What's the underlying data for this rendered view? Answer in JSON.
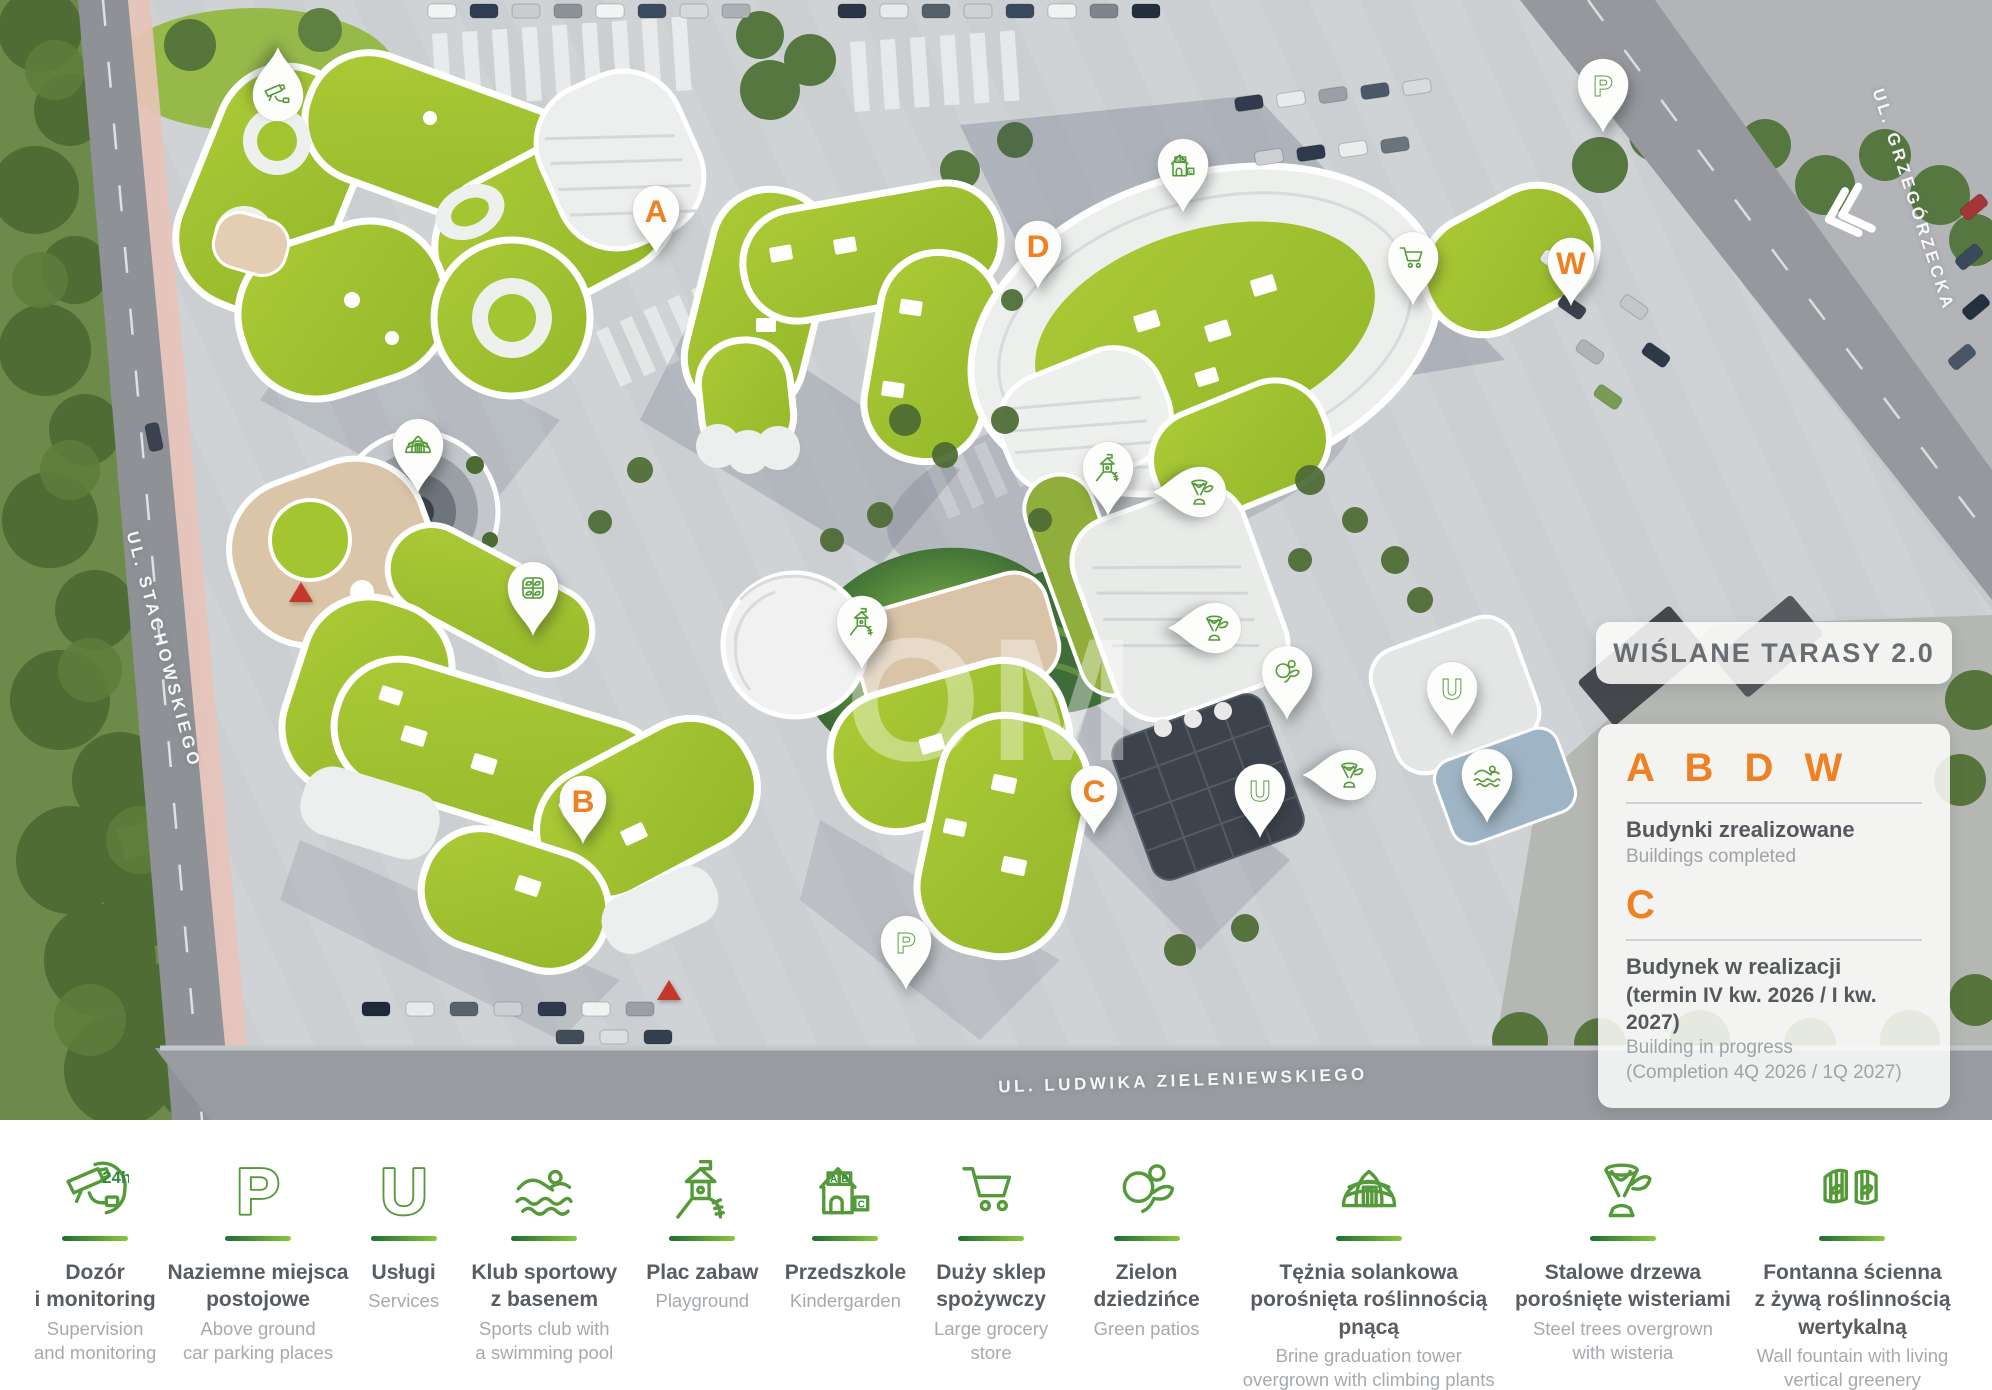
{
  "map": {
    "watermark": "OM",
    "title_panel": {
      "title": "WIŚLANE TARASY 2.0"
    },
    "status_panel": {
      "completed_letters": "A B D W",
      "completed_title_pl": "Budynki zrealizowane",
      "completed_title_en": "Buildings completed",
      "in_progress_letter": "C",
      "in_progress_title_pl": "Budynek w realizacji",
      "in_progress_term_pl": "(termin IV kw. 2026 / I kw. 2027)",
      "in_progress_title_en": "Building in progress",
      "in_progress_term_en": "(Completion 4Q 2026 / 1Q 2027)"
    },
    "streets": [
      {
        "name": "UL. STACHOWSKIEGO",
        "x": 163,
        "y": 650,
        "rotate": 75
      },
      {
        "name": "UL. GRZEGÓRZECKA",
        "x": 1913,
        "y": 200,
        "rotate": 72
      },
      {
        "name": "UL. LUDWIKA ZIELENIEWSKIEGO",
        "x": 1183,
        "y": 1081,
        "rotate": -2
      }
    ],
    "building_markers": [
      {
        "label": "A",
        "status": "completed",
        "x": 656,
        "y": 210
      },
      {
        "label": "D",
        "status": "completed",
        "x": 1038,
        "y": 245
      },
      {
        "label": "W",
        "status": "completed",
        "x": 1571,
        "y": 262
      },
      {
        "label": "B",
        "status": "completed",
        "x": 583,
        "y": 800
      },
      {
        "label": "C",
        "status": "in_progress",
        "x": 1094,
        "y": 790
      }
    ],
    "amenity_markers": [
      {
        "icon": "cctv-camera",
        "x": 278,
        "y": 95,
        "dir": "up"
      },
      {
        "icon": "parking",
        "letter": "P",
        "x": 1603,
        "y": 85,
        "dir": "down"
      },
      {
        "icon": "kindergarten",
        "x": 1183,
        "y": 165,
        "dir": "down"
      },
      {
        "icon": "grocery-cart",
        "x": 1413,
        "y": 258,
        "dir": "down"
      },
      {
        "icon": "brine-tower",
        "x": 418,
        "y": 445,
        "dir": "down"
      },
      {
        "icon": "green-window",
        "x": 533,
        "y": 588,
        "dir": "down"
      },
      {
        "icon": "playground",
        "x": 1108,
        "y": 468,
        "dir": "down"
      },
      {
        "icon": "steel-tree",
        "x": 1200,
        "y": 492,
        "dir": "left"
      },
      {
        "icon": "playground",
        "x": 862,
        "y": 622,
        "dir": "down"
      },
      {
        "icon": "steel-tree",
        "x": 1215,
        "y": 628,
        "dir": "left"
      },
      {
        "icon": "green-patios",
        "x": 1287,
        "y": 672,
        "dir": "down"
      },
      {
        "icon": "services",
        "letter": "U",
        "x": 1452,
        "y": 688,
        "dir": "down"
      },
      {
        "icon": "steel-tree",
        "x": 1350,
        "y": 775,
        "dir": "left"
      },
      {
        "icon": "swimming",
        "x": 1487,
        "y": 775,
        "dir": "down"
      },
      {
        "icon": "services",
        "letter": "U",
        "x": 1260,
        "y": 790,
        "dir": "down"
      },
      {
        "icon": "parking",
        "letter": "P",
        "x": 906,
        "y": 942,
        "dir": "down"
      }
    ],
    "symbols": [
      {
        "type": "red-triangle",
        "x": 301,
        "y": 592
      },
      {
        "type": "red-triangle",
        "x": 669,
        "y": 990
      },
      {
        "type": "chevron-left",
        "x": 1842,
        "y": 215
      }
    ]
  },
  "legend_bar": {
    "items": [
      {
        "icon": "cctv-camera",
        "badge": "24h",
        "pl": "Dozór\ni monitoring",
        "en": "Supervision\nand monitoring",
        "w": 140
      },
      {
        "icon": "parking",
        "letter": "P",
        "pl": "Naziemne miejsca\npostojowe",
        "en": "Above ground\ncar parking places",
        "w": 190
      },
      {
        "icon": "services",
        "letter": "U",
        "pl": "Usługi",
        "en": "Services",
        "w": 105
      },
      {
        "icon": "swimming",
        "pl": "Klub sportowy\nz basenem",
        "en": "Sports club with\na swimming pool",
        "w": 180
      },
      {
        "icon": "playground",
        "pl": "Plac zabaw",
        "en": "Playground",
        "w": 140
      },
      {
        "icon": "kindergarten",
        "blocks": [
          "A",
          "B",
          "C"
        ],
        "pl": "Przedszkole",
        "en": "Kindergarden",
        "w": 150
      },
      {
        "icon": "grocery-cart",
        "pl": "Duży sklep\nspożywczy",
        "en": "Large grocery\nstore",
        "w": 145
      },
      {
        "icon": "green-patios",
        "pl": "Zielon dziedzińce",
        "en": "Green patios",
        "w": 170
      },
      {
        "icon": "brine-tower",
        "pl": "Tężnia solankowa\nporośnięta roślinnością\npnącą",
        "en": "Brine graduation tower\novergrown with climbing plants",
        "w": 280
      },
      {
        "icon": "steel-tree",
        "pl": "Stalowe drzewa\nporośnięte wisteriami",
        "en": "Steel trees overgrown\nwith wisteria",
        "w": 235
      },
      {
        "icon": "wall-fountain",
        "pl": "Fontanna ścienna\nz żywą roślinnością\nwertykalną",
        "en": "Wall fountain with living\nvertical greenery",
        "w": 230
      }
    ]
  },
  "colors": {
    "accent_orange": "#ee8124",
    "accent_green_dark": "#1c6e33",
    "accent_green_light": "#8dc63f",
    "roof_green": "#a3c52f"
  }
}
